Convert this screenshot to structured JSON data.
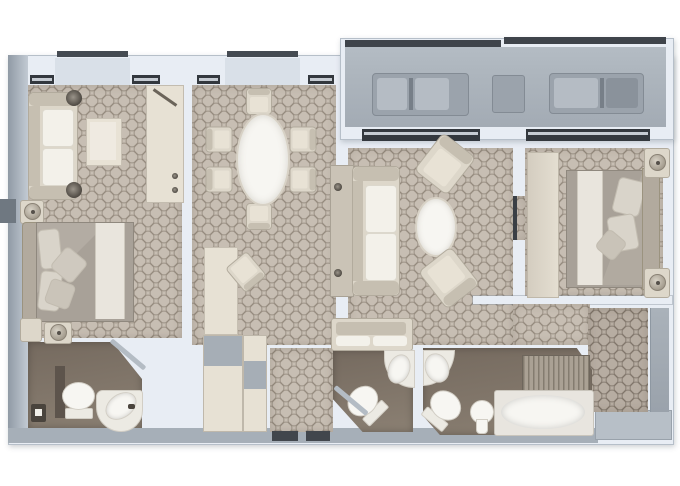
{
  "scene": {
    "kind": "floor-plan",
    "render_style": "3d-top-down",
    "width_px": 680,
    "height_px": 486
  },
  "palette": {
    "wall-fill": "#e8edf4",
    "wall-edge": "#b6bfc9",
    "wall-niche": "#d9e0e8",
    "outer-a": "#909aa5",
    "outer-b": "#c2cad3",
    "outer-bottom": "#a6afb8",
    "carpet-base": "#c7beb3",
    "carpet-line": "rgba(122,111,98,0.55)",
    "carpet2-base": "#b7ada2",
    "carpet2-line": "rgba(99,88,77,0.55)",
    "bath-a": "#756a5f",
    "bath-b": "#8b8073",
    "deck": "#aeb6be",
    "rail": "#3f444b",
    "lounger": "#9ba3ac",
    "lounger-cushion": "#b5bcc4",
    "lounger-back": "#8a929b",
    "lounger-seam": "#777f88",
    "fixture": "#f7f6f2",
    "fixture-edge": "#d2cec5",
    "fixture-mid": "#eceae3",
    "furn": "#ddd7ca",
    "furn-edge": "#b2ab9d",
    "furn-dark": "#c6bfb1",
    "furn-cream": "#e8e2d5",
    "cushion": "#f3f1ea",
    "duvet": "#a8a198",
    "duvet-fold": "#b3aca3",
    "runner": "#e9e5dd",
    "headboard": "#b2aa9e",
    "pillow": "#d9d4ca",
    "sill-dark": "#33383e",
    "sill-light": "#c5cbd2",
    "mat": "#41464c",
    "shelf": "#a6aeb6",
    "cream": "#e7e1d4",
    "terrace": "#b7bfc7",
    "stripe-a": "#aaa194",
    "stripe-b": "#847c6f",
    "door-leaf": "#b4bcc4",
    "dark-accent": "#5d544c",
    "knob": "#4e4942",
    "lamp-a": "#d8d2c6",
    "lamp-b": "#a29a8c"
  },
  "rooms": [
    {
      "id": "second-bedroom"
    },
    {
      "id": "dining-area"
    },
    {
      "id": "foyer-desk-area"
    },
    {
      "id": "living-room"
    },
    {
      "id": "master-bedroom"
    },
    {
      "id": "balcony"
    },
    {
      "id": "guest-bathroom"
    },
    {
      "id": "powder-room"
    },
    {
      "id": "master-bathroom"
    },
    {
      "id": "walk-in-closet"
    },
    {
      "id": "entry-hall"
    },
    {
      "id": "dressing-area"
    },
    {
      "id": "shower"
    }
  ],
  "furniture": [
    {
      "item": "sofa",
      "room": "second-bedroom"
    },
    {
      "item": "ottoman-table",
      "room": "second-bedroom"
    },
    {
      "item": "wardrobe",
      "room": "second-bedroom"
    },
    {
      "item": "double-bed",
      "room": "second-bedroom"
    },
    {
      "item": "nightstand-with-lamp",
      "room": "second-bedroom",
      "count": 2
    },
    {
      "item": "oval-dining-table",
      "room": "dining-area"
    },
    {
      "item": "dining-chair",
      "room": "dining-area",
      "count": 6
    },
    {
      "item": "writing-desk",
      "room": "foyer-desk-area"
    },
    {
      "item": "desk-chair",
      "room": "foyer-desk-area"
    },
    {
      "item": "sofa-with-console",
      "room": "living-room"
    },
    {
      "item": "oval-coffee-table",
      "room": "living-room"
    },
    {
      "item": "armchair",
      "room": "living-room",
      "count": 2
    },
    {
      "item": "settee",
      "room": "living-room"
    },
    {
      "item": "dresser",
      "room": "master-bedroom"
    },
    {
      "item": "double-bed",
      "room": "master-bedroom"
    },
    {
      "item": "nightstand-with-lamp",
      "room": "master-bedroom",
      "count": 2
    },
    {
      "item": "sun-lounger",
      "room": "balcony",
      "count": 2
    },
    {
      "item": "side-table",
      "room": "balcony"
    },
    {
      "item": "toilet",
      "room": "guest-bathroom"
    },
    {
      "item": "corner-washbasin",
      "room": "guest-bathroom"
    },
    {
      "item": "toilet",
      "room": "powder-room"
    },
    {
      "item": "corner-washbasin",
      "room": "powder-room"
    },
    {
      "item": "washbasin",
      "room": "master-bathroom"
    },
    {
      "item": "toilet",
      "room": "master-bathroom"
    },
    {
      "item": "bidet",
      "room": "master-bathroom"
    },
    {
      "item": "bathtub",
      "room": "master-bathroom"
    },
    {
      "item": "slatted-bench",
      "room": "master-bathroom"
    },
    {
      "item": "shelving",
      "room": "walk-in-closet"
    },
    {
      "item": "door-mat",
      "room": "entry-hall",
      "count": 2
    }
  ]
}
